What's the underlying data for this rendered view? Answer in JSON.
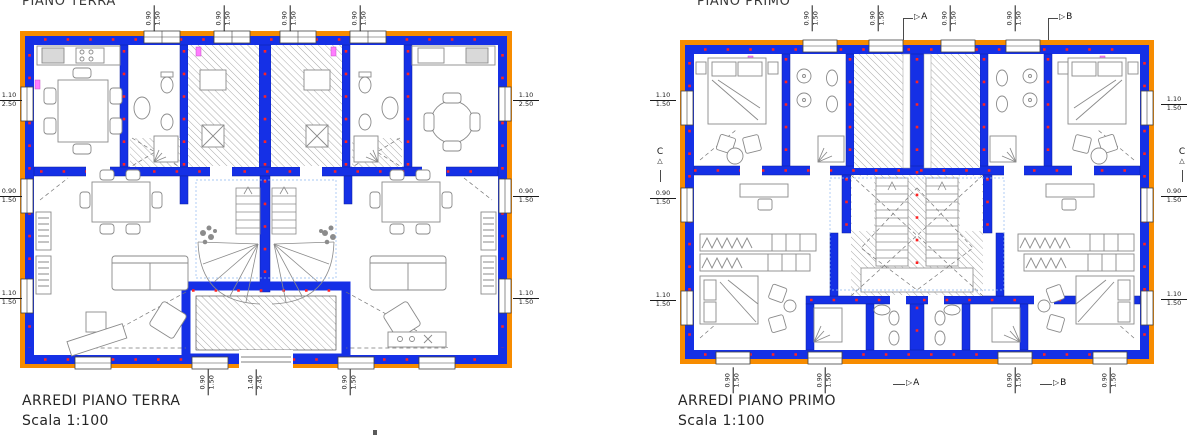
{
  "page": {
    "background": "#ffffff"
  },
  "colors": {
    "outer_wall_orange": "#F78C00",
    "wall_blue": "#1530E6",
    "dot_red": "#FF2222",
    "vent_pink": "#FF7DFF",
    "furniture_gray": "#8A8A8A",
    "hatch_gray": "#9A9A9A",
    "text_dark": "#262626"
  },
  "plans": [
    {
      "title": "PIANO TERRA",
      "caption_title": "ARREDI PIANO TERRA",
      "caption_scale": "Scala 1:100"
    },
    {
      "title": "PIANO PRIMO",
      "caption_title": "ARREDI PIANO PRIMO",
      "caption_scale": "Scala 1:100"
    }
  ],
  "sections": {
    "a": "A",
    "b": "B",
    "c": "C"
  },
  "dims": {
    "d090_150": {
      "w": "0.90",
      "h": "1.50"
    },
    "d110_250": {
      "w": "1.10",
      "h": "2.50"
    },
    "d110_150": {
      "w": "1.10",
      "h": "1.50"
    },
    "d140_245": {
      "w": "1.40",
      "h": "2.45"
    }
  }
}
